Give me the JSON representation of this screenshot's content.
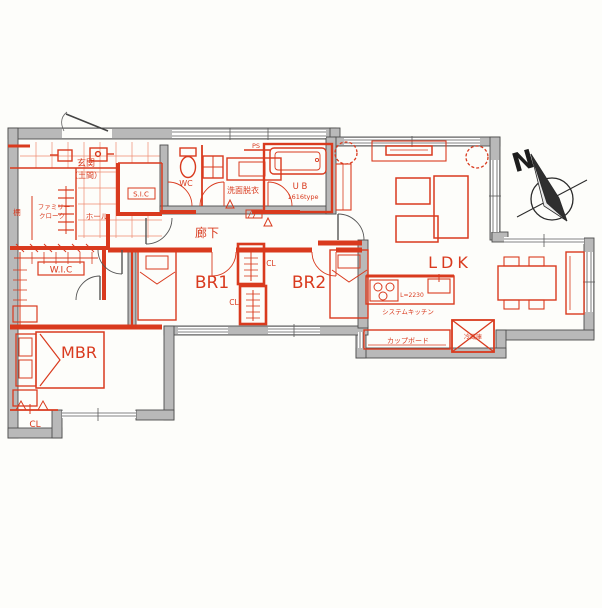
{
  "plan": {
    "description": "Hand-annotated Japanese apartment floor plan, red renovation sketch over gray base walls",
    "colors": {
      "annotation_red": "#d93a1e",
      "grid_red": "#ee8a70",
      "wall_gray": "#b9b9b9",
      "wall_outline": "#4d4d4d",
      "background": "#fdfdfa"
    },
    "compass": {
      "label": "N"
    },
    "labels": {
      "genkan_line1": "玄関",
      "genkan_line2": "（土間）",
      "family_cloak_line1": "ファミリー",
      "family_cloak_line2": "クローク",
      "shelf": "棚",
      "hall": "ホール",
      "sic": "S.I.C",
      "wc": "WC",
      "ps": "PS",
      "washroom": "洗面脱衣",
      "unit_bath": "U B",
      "unit_bath_size": "1616type",
      "corridor": "廊下",
      "wic": "W.I.C",
      "bedroom1": "BR1",
      "bedroom2": "BR2",
      "closet_br_upper": "CL",
      "closet_br_lower": "CL",
      "master_bedroom": "MBR",
      "closet_mbr": "CL",
      "ldk": "LDK",
      "kitchen_length": "L=2230",
      "system_kitchen": "システムキッチン",
      "cupboard": "カップボード",
      "refrigerator": "冷蔵庫"
    }
  }
}
